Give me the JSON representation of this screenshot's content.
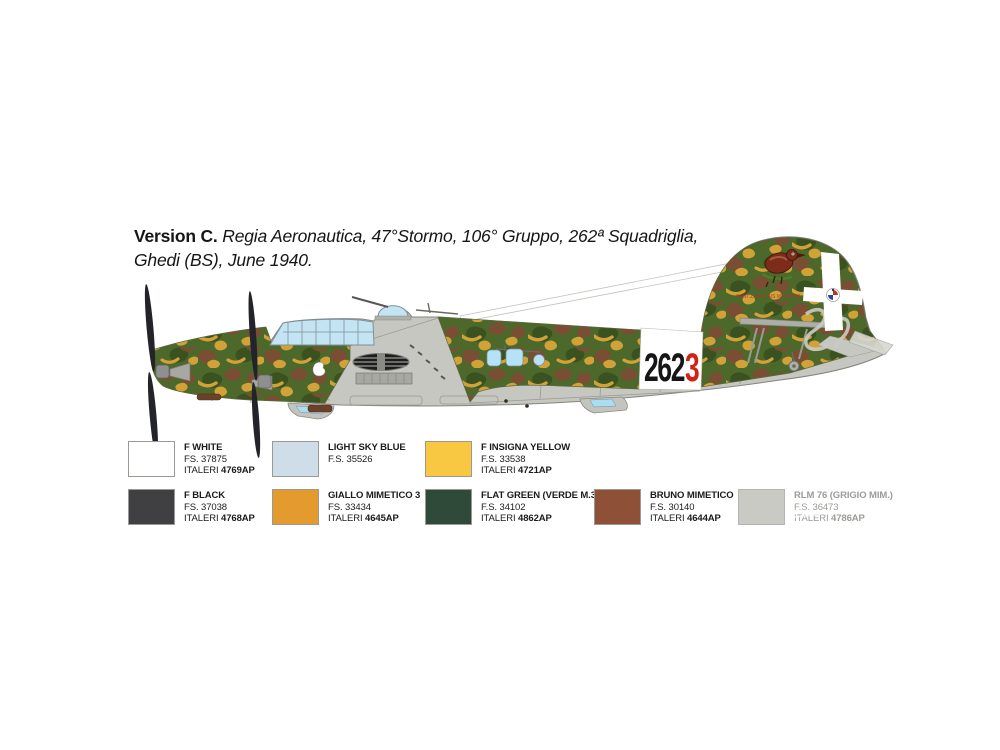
{
  "header": {
    "version_label": "Version C.",
    "subtitle_line1": "Regia Aeronautica, 47°Stormo, 106° Gruppo, 262ª Squadriglia,",
    "subtitle_line2": "Ghedi (BS), June 1940."
  },
  "aircraft": {
    "fuselage_code": "262",
    "aircraft_number": "3",
    "fin_serial": "CANT.Z.1007 BIS MM 23459",
    "colors": {
      "camo_green": "#4c682a",
      "camo_brown": "#7a4e33",
      "camo_yellow": "#d2a239",
      "underside_gray": "#c7c7c1",
      "glazing_blue": "#c3e4f2",
      "band_white": "#ffffff",
      "code_black": "#161616",
      "code_red": "#d42015",
      "propeller_dark": "#23232a"
    }
  },
  "palette": {
    "swatches": [
      {
        "name": "F WHITE",
        "fs": "FS. 37875",
        "brand": "ITALERI",
        "code": "4769AP",
        "color": "#ffffff"
      },
      {
        "name": "LIGHT SKY BLUE",
        "fs": "F.S. 35526",
        "brand": "",
        "code": "",
        "color": "#cedde7"
      },
      {
        "name": "F INSIGNA YELLOW",
        "fs": "F.S. 33538",
        "brand": "ITALERI",
        "code": "4721AP",
        "color": "#f9c843"
      },
      {
        "name": "F BLACK",
        "fs": "FS. 37038",
        "brand": "ITALERI",
        "code": "4768AP",
        "color": "#404042"
      },
      {
        "name": "GIALLO MIMETICO 3",
        "fs": "FS. 33434",
        "brand": "ITALERI",
        "code": "4645AP",
        "color": "#e29b2c"
      },
      {
        "name": "FLAT GREEN (VERDE M.3)",
        "fs": "F.S. 34102",
        "brand": "ITALERI",
        "code": "4862AP",
        "color": "#2f4a39"
      },
      {
        "name": "BRUNO MIMETICO",
        "fs": "F.S. 30140",
        "brand": "ITALERI",
        "code": "4644AP",
        "color": "#8e5137"
      },
      {
        "name": "RLM 76 (GRIGIO MIM.)",
        "fs": "F.S. 36473",
        "brand": "ITALERI",
        "code": "4786AP",
        "color": "#c9cac3"
      }
    ]
  }
}
